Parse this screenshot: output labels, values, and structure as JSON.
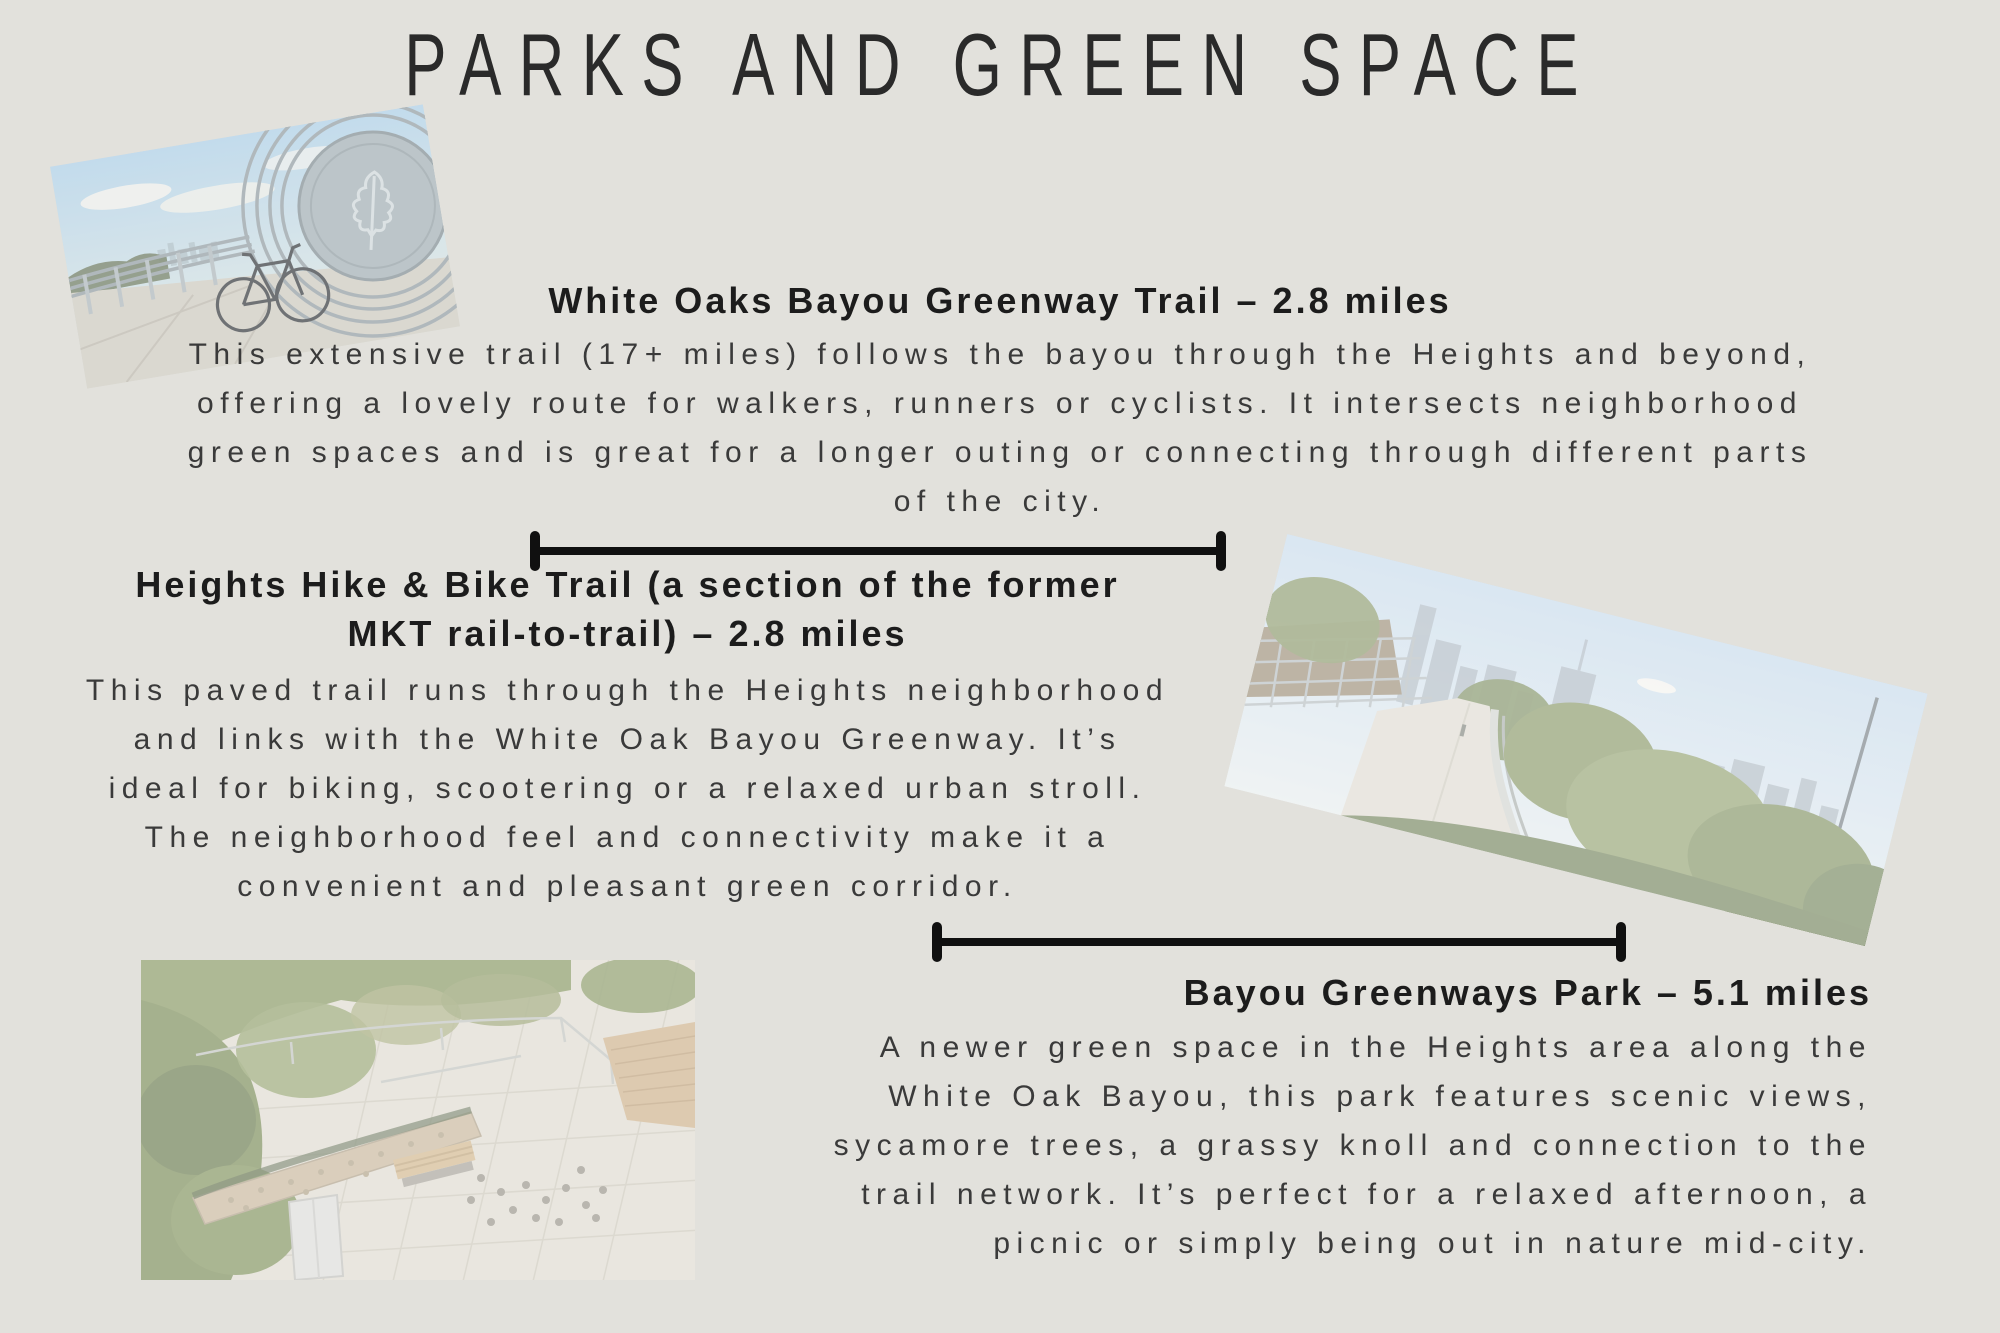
{
  "page": {
    "title": "PARKS AND GREEN SPACE",
    "background_color": "#e2e1dc",
    "title_color": "#2a2a2a",
    "heading_color": "#1c1c1c",
    "body_color": "#3a3a3a",
    "divider_color": "#101010"
  },
  "sections": [
    {
      "id": "white-oaks-bayou-greenway-trail",
      "heading": "White Oaks Bayou Greenway Trail  – 2.8 miles",
      "body_lines": [
        "This extensive trail (17+ miles) follows the bayou through the Heights and beyond,",
        "offering a lovely route for walkers, runners or cyclists. It intersects neighborhood",
        "green spaces and is great for a longer outing or connecting through different parts",
        "of the city."
      ]
    },
    {
      "id": "heights-hike-and-bike-trail",
      "heading_lines": [
        "Heights Hike & Bike Trail (a section of the former",
        "MKT rail-to-trail) – 2.8 miles"
      ],
      "body_lines": [
        "This paved trail runs through the Heights neighborhood",
        "and links with the White Oak Bayou Greenway. It’s",
        "ideal for biking, scootering or a relaxed urban stroll.",
        "The neighborhood feel and connectivity make it a",
        "convenient and pleasant green corridor."
      ]
    },
    {
      "id": "bayou-greenways-park",
      "heading": "Bayou Greenways Park – 5.1 miles",
      "body_lines": [
        "A newer green space in the Heights area along the",
        "White Oak Bayou, this park features scenic views,",
        "sycamore trees, a grassy knoll and connection to the",
        "trail network. It’s perfect for a relaxed afternoon, a",
        "picnic or simply being out in nature mid-city."
      ]
    }
  ],
  "photos": [
    {
      "name": "bridge-bike-photo",
      "description": "Bicycle leaning on curved bridge railing with oak-leaf medallion and distant skyline"
    },
    {
      "name": "trail-skyline-photo",
      "description": "Greenway trail with railing, trees and downtown Houston skyline"
    },
    {
      "name": "park-plaza-aerial-photo",
      "description": "Aerial view of park plaza with bench, gabion wall, railings and trees"
    }
  ]
}
